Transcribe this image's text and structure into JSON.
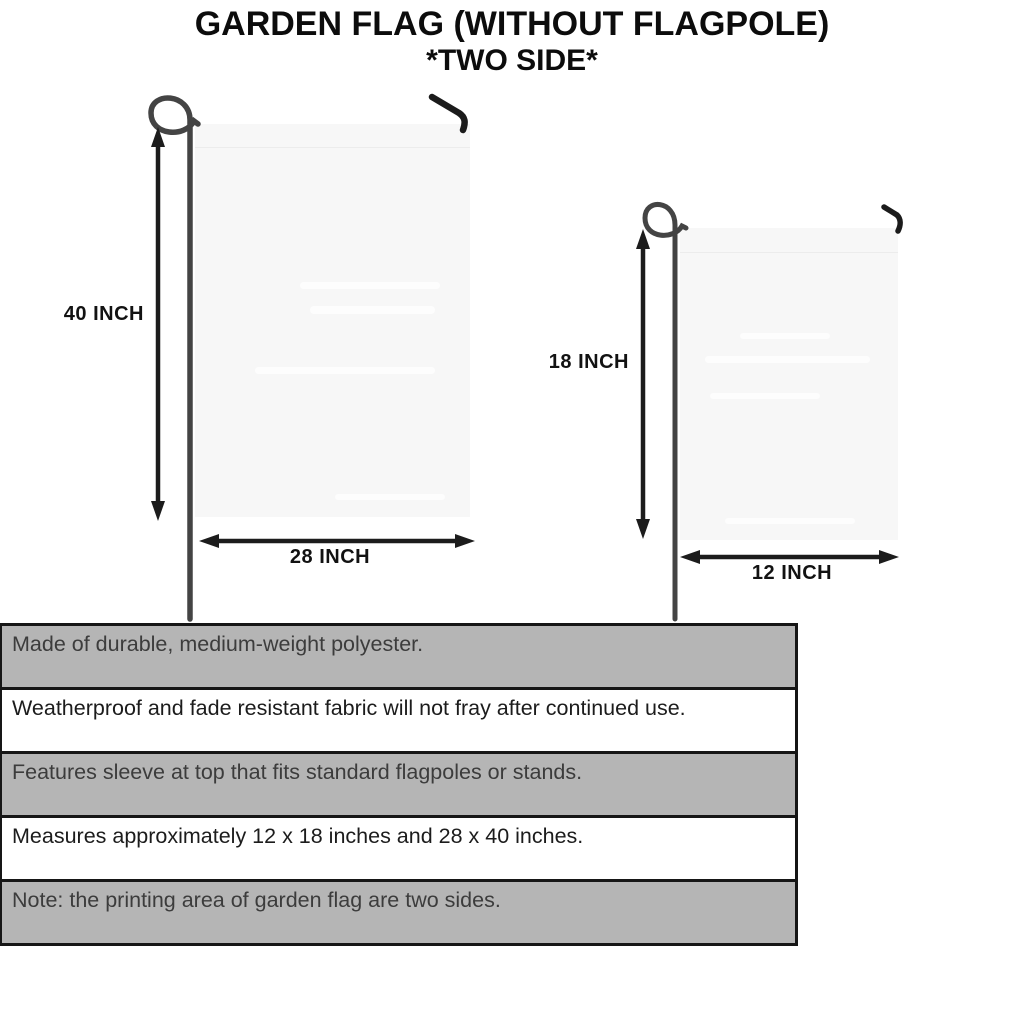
{
  "title": {
    "line1": "GARDEN FLAG (WITHOUT FLAGPOLE)",
    "line2": "*TWO SIDE*"
  },
  "flags": {
    "large": {
      "height_label": "40 INCH",
      "width_label": "28 INCH"
    },
    "small": {
      "height_label": "18 INCH",
      "width_label": "12 INCH"
    }
  },
  "features": {
    "rows": [
      {
        "text": "Made of durable, medium-weight polyester."
      },
      {
        "text": "Weatherproof and fade resistant fabric will not fray after continued use."
      },
      {
        "text": "Features sleeve at top that fits standard flagpoles or stands."
      },
      {
        "text": "Measures approximately 12 x 18 inches and 28 x 40 inches."
      },
      {
        "text": "Note: the printing area of garden flag are two sides."
      }
    ]
  },
  "colors": {
    "table_row_gray": "#b5b5b5",
    "table_border": "#161616",
    "flag_fill": "#f7f7f7",
    "pole": "#444444",
    "hook": "#1b1b1b",
    "arrow": "#1c1c1c",
    "title_text": "#0c0c0c"
  }
}
